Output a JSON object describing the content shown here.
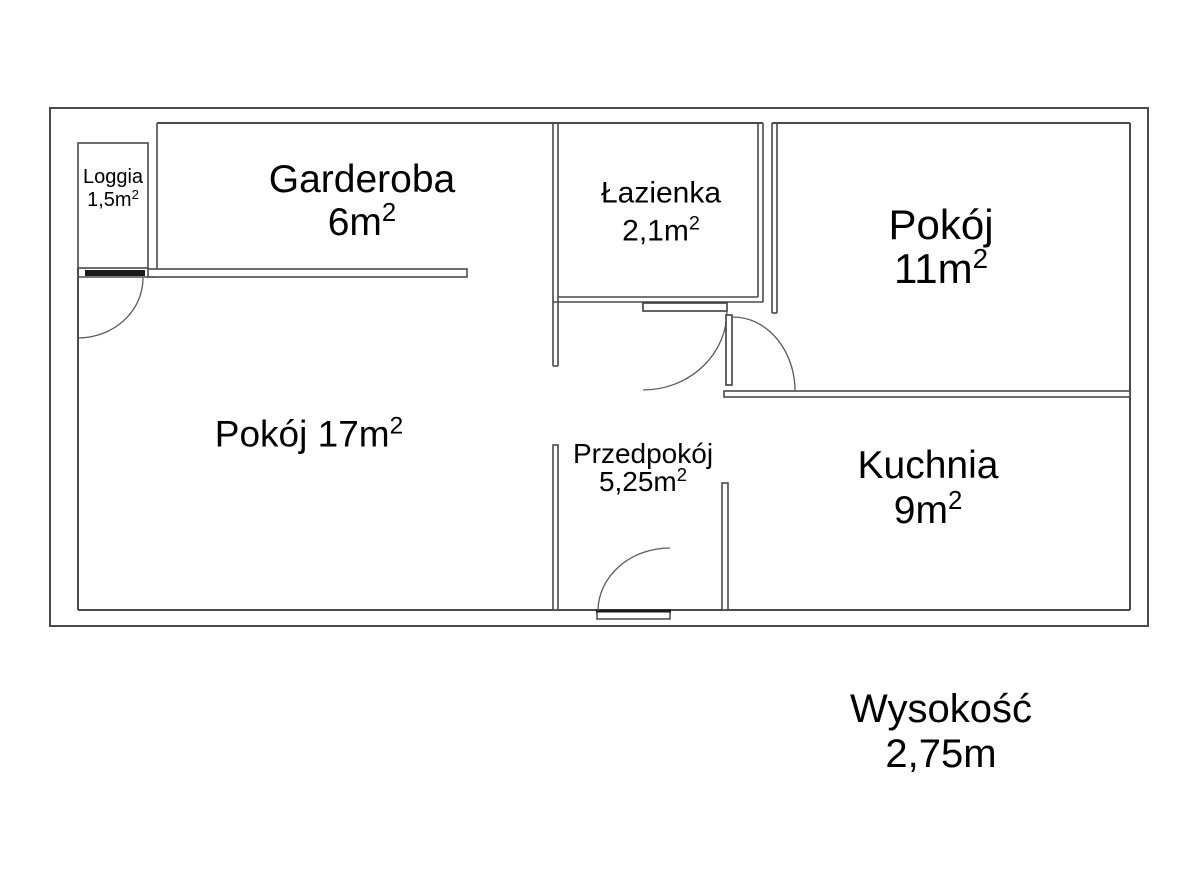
{
  "floorplan": {
    "rooms": {
      "loggia": {
        "name": "Loggia",
        "area": "1,5m",
        "area_sup": "2"
      },
      "garderoba": {
        "name": "Garderoba",
        "area": "6m",
        "area_sup": "2"
      },
      "lazienka": {
        "name": "Łazienka",
        "area": "2,1m",
        "area_sup": "2"
      },
      "pokoj_11": {
        "name": "Pokój",
        "area": "11m",
        "area_sup": "2"
      },
      "pokoj_17": {
        "label": "Pokój 17m",
        "label_sup": "2"
      },
      "przedpokoj": {
        "name": "Przedpokój",
        "area": "5,25m",
        "area_sup": "2"
      },
      "kuchnia": {
        "name": "Kuchnia",
        "area": "9m",
        "area_sup": "2"
      }
    },
    "annotation": {
      "title": "Wysokość",
      "value": "2,75m"
    },
    "colors": {
      "wall": "#4a4a4a",
      "door_leaf": "#1a1a1a",
      "text": "#000000",
      "background": "#ffffff"
    }
  }
}
